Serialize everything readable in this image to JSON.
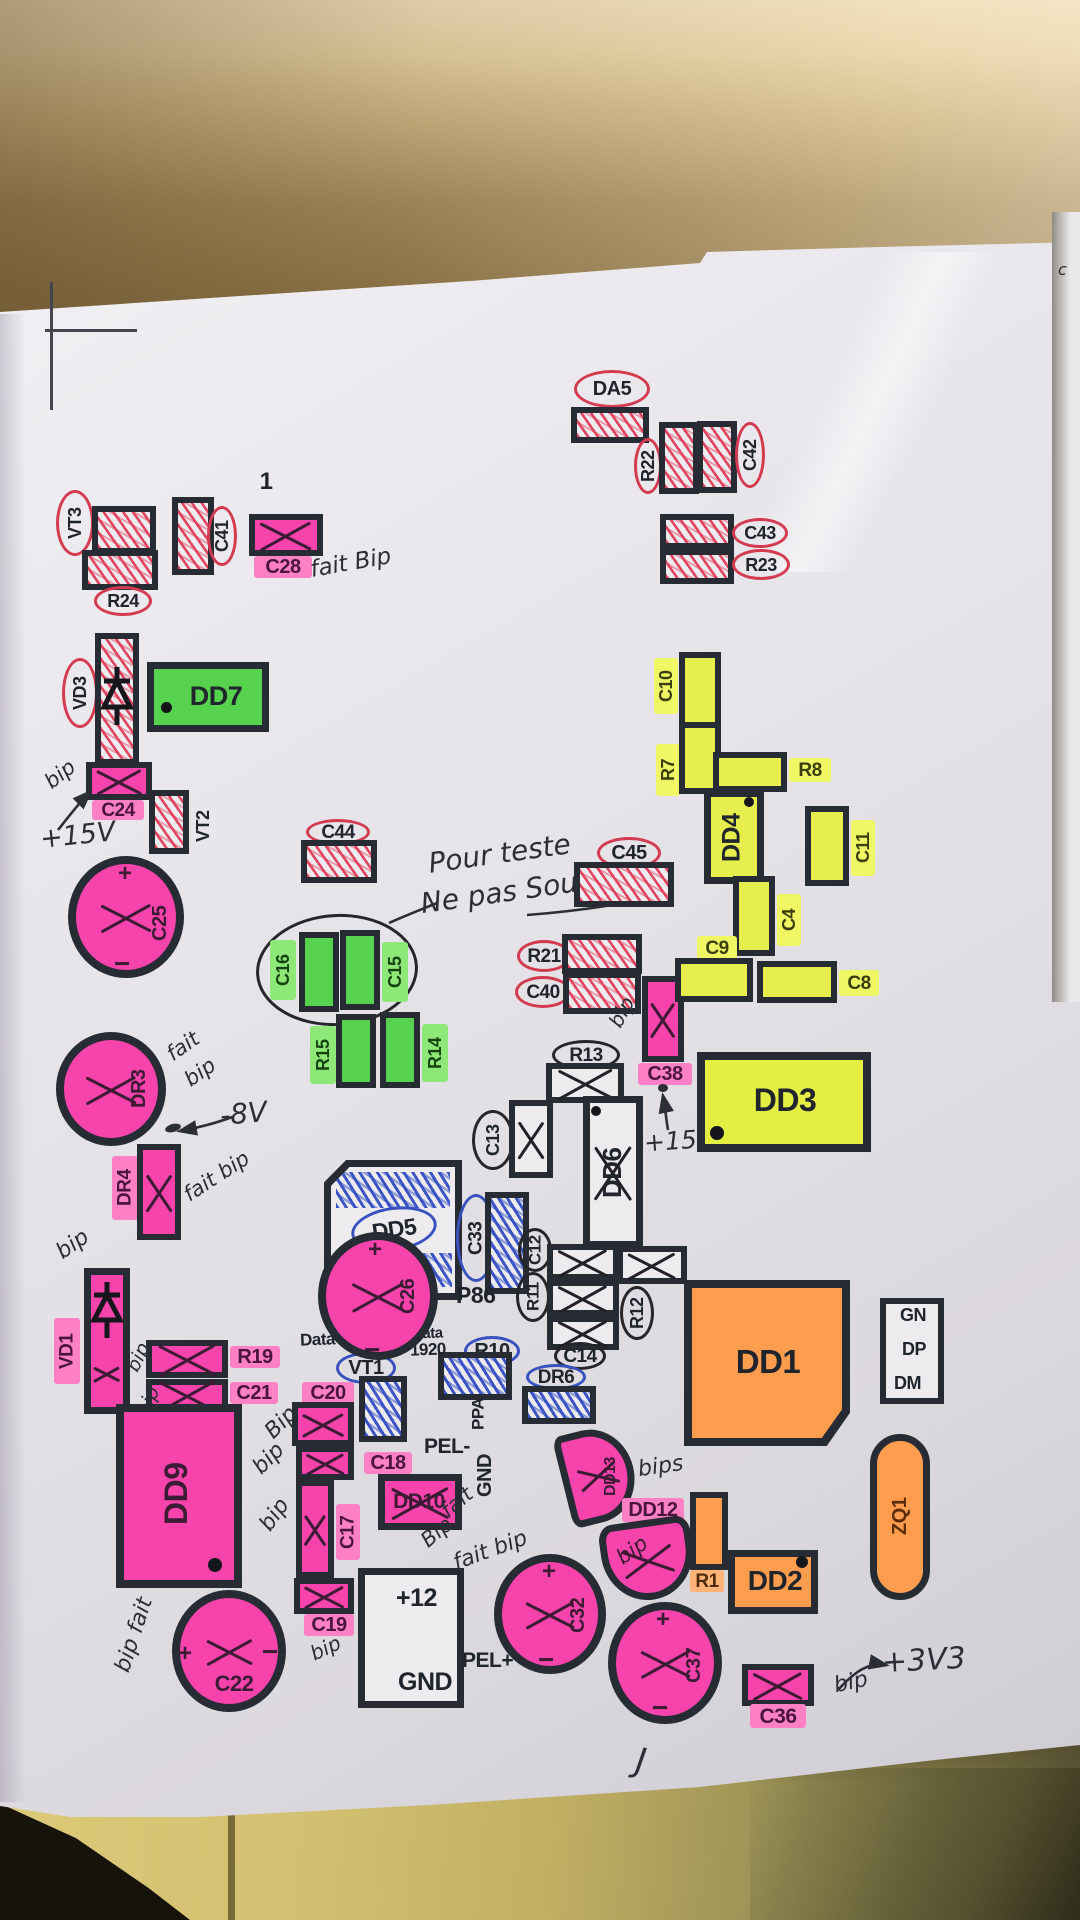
{
  "colors": {
    "paper": "#e7e5e9",
    "outline_pen": "#262b34",
    "red_pen": "#d43a50",
    "red_hatch": "#e14e66",
    "pink_marker": "#f743ac",
    "pink_label_bg": "#ff80c4",
    "green_marker": "#56d24e",
    "green_label_bg": "#8ee878",
    "yellow_marker": "#e6ee4d",
    "yellow_label_bg": "#eff765",
    "orange_marker": "#ff9d4f",
    "blue_pen": "#3752c0",
    "black_pen": "#2b2e35",
    "wall": "#e9d5ae",
    "wall_shadow": "#8d7245",
    "ledge_wood": "#cdbb6e"
  },
  "labels": {
    "vt3": "VT3",
    "r24": "R24",
    "c41": "C41",
    "c28": "C28",
    "da5": "DA5",
    "r22": "R22",
    "c42": "C42",
    "c43": "C43",
    "r23": "R23",
    "vd3": "VD3",
    "dd7": "DD7",
    "c24": "C24",
    "vt2": "VT2",
    "c25": "C25",
    "c44": "C44",
    "c45": "C45",
    "c16": "C16",
    "c15": "C15",
    "r15": "R15",
    "r14": "R14",
    "r21": "R21",
    "c40": "C40",
    "c38": "C38",
    "r13": "R13",
    "c13": "C13",
    "dd6": "DD6",
    "dd3": "DD3",
    "c10": "C10",
    "r7": "R7",
    "r8": "R8",
    "dd4": "DD4",
    "c11": "C11",
    "c4": "C4",
    "c9": "C9",
    "c8": "C8",
    "dr3": "DR3",
    "dr4": "DR4",
    "dd5": "DD5",
    "c33": "C33",
    "c12": "C12",
    "r11": "R11",
    "r12": "R12",
    "c14": "C14",
    "dr6": "DR6",
    "r10": "R10",
    "vt1": "VT1",
    "c26": "C26",
    "vd1": "VD1",
    "r19": "R19",
    "c21": "C21",
    "dd9": "DD9",
    "c20": "C20",
    "c18": "C18",
    "c17": "C17",
    "c19": "C19",
    "dd10": "DD10",
    "dd13": "DD13",
    "dd12": "DD12",
    "r1": "R1",
    "dd2": "DD2",
    "dd1": "DD1",
    "zq1": "ZQ1",
    "c22": "C22",
    "c32": "C32",
    "c37": "C37",
    "c36": "C36"
  },
  "printed": {
    "one": "1",
    "plus": "+",
    "minus": "−",
    "p86": "P86",
    "data_dht22": "Data DHT22",
    "data_word": "Data",
    "data_num": "1920",
    "ppa": "PPA",
    "pel_minus": "PEL-",
    "gnd_vertical": "GND",
    "plus12": "+12",
    "gnd": "GND",
    "pel_plus": "PEL+",
    "gn": "GN",
    "dp": "DP",
    "dm": "DM"
  },
  "handwritten": {
    "c28_note": "fait Bip",
    "c24_note": "bip",
    "plus15v_left": "+15V",
    "teste_line1": "Pour teste",
    "teste_line2": "Ne pas Souder",
    "c38_note": "bip",
    "c38_plus15v": "+15V",
    "dr3_note1": "fait",
    "dr3_note2": "bip",
    "minus8v": "-8V",
    "dr4_note": "fait bip",
    "vd1_note": "bip",
    "r19_note": "bip",
    "c21_note": "bip",
    "c20_note": "Bip",
    "c18_note": "bip",
    "c17_note": "bip",
    "c19_note": "bip",
    "dd10_note1": "fait",
    "dd10_note2": "Bip",
    "dd13_note": "bips",
    "dd12_note": "bip",
    "c22_note": "bip fait",
    "c32_note": "fait bip",
    "c36_note": "bip",
    "plus3v3": "+3V3",
    "squiggle": "J",
    "corner_mark": "c"
  }
}
